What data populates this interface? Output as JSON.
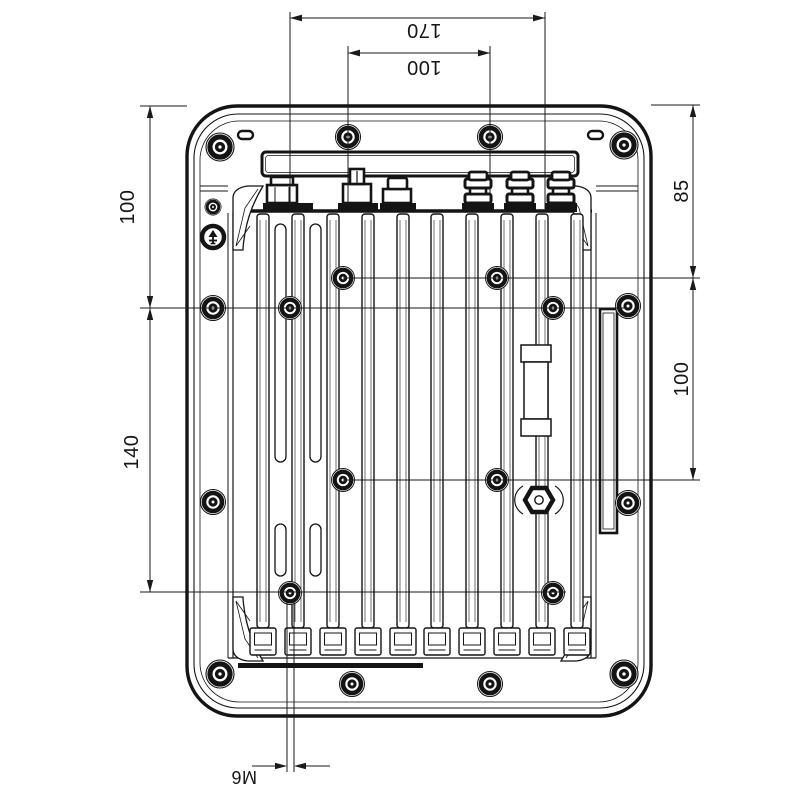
{
  "drawing": {
    "kind": "cad-dimension-drawing",
    "view_label": "rear-view-with-mounting-dimensions",
    "background": "#ffffff",
    "line_color": "#141414"
  },
  "dims": {
    "top_outer": "170",
    "top_inner": "100",
    "left_upper": "100",
    "left_lower": "140",
    "right_upper": "85",
    "right_lower": "100",
    "thread_callout": "M6"
  },
  "features": {
    "fin_count": 10,
    "coax_connector_count": 3,
    "screw_icon": "torx-screw-head",
    "ground_icon": "earth-ground-terminal",
    "gland_icon": "hex-gland-nut",
    "rail_icon": "mounting-rail"
  }
}
